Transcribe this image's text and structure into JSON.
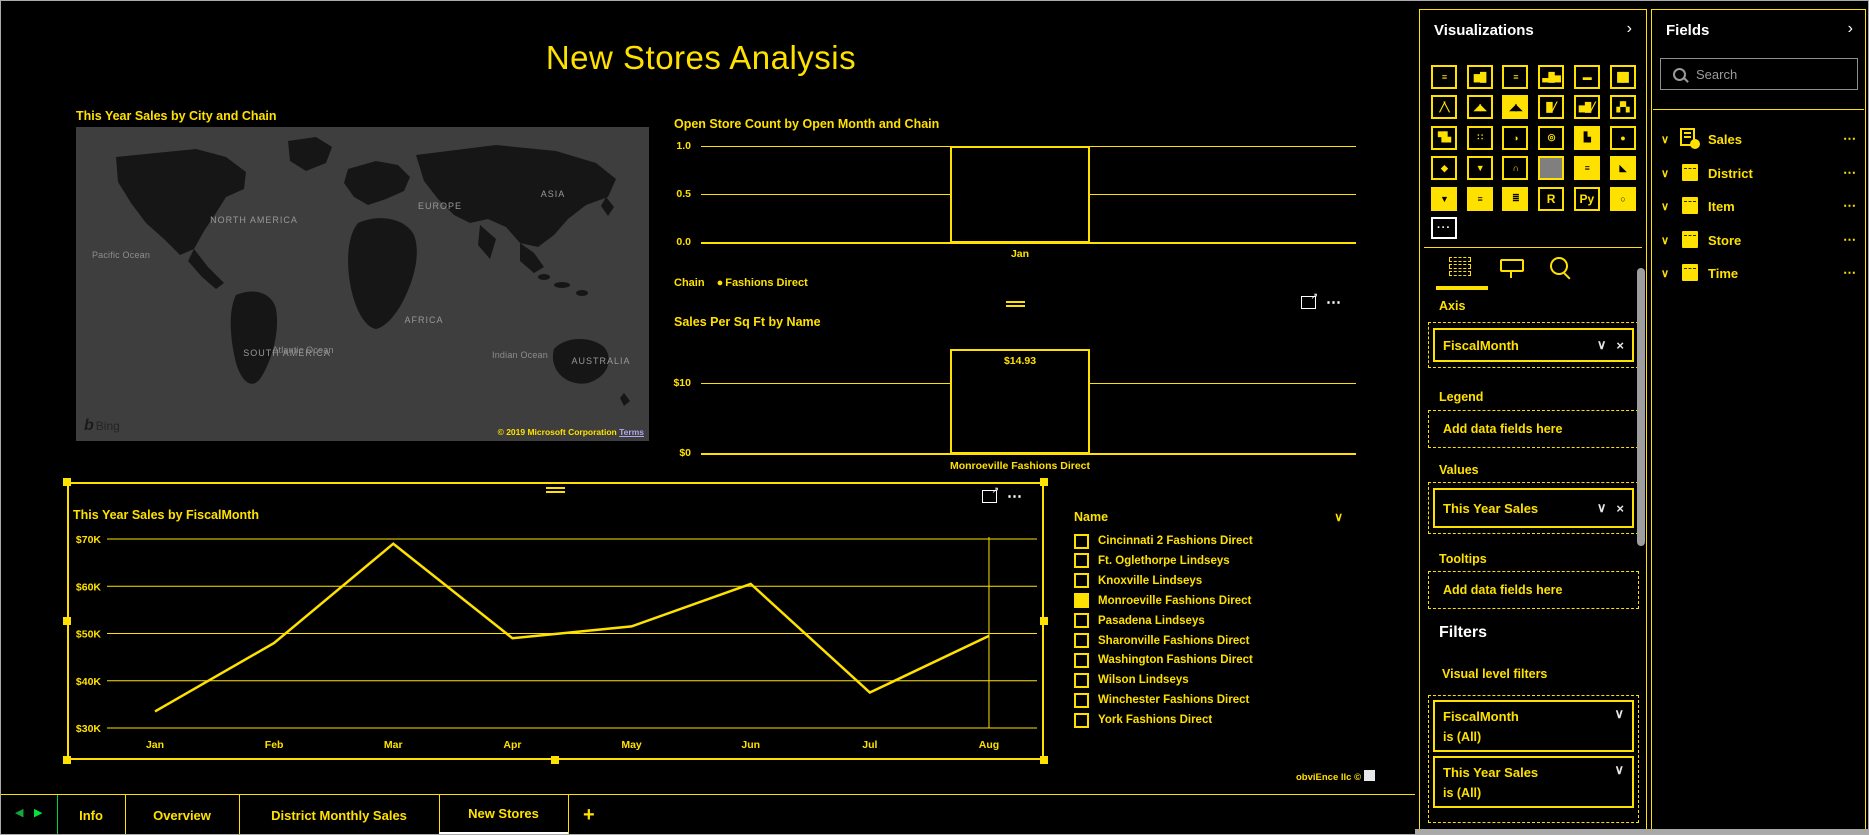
{
  "page_title": "New Stores Analysis",
  "glyphs": {
    "chevron_down": "∨",
    "chevron_right": "›",
    "close": "×",
    "ellipsis": "⋯",
    "dots": "···",
    "focus_arrow": "↗",
    "bullet": "●",
    "arrow_left": "◀",
    "arrow_right": "▶"
  },
  "map": {
    "title": "This Year Sales by City and Chain",
    "continents": [
      "NORTH AMERICA",
      "EUROPE",
      "ASIA",
      "AFRICA",
      "SOUTH AMERICA",
      "AUSTRALIA"
    ],
    "oceans": [
      "Pacific Ocean",
      "Atlantic Ocean",
      "Indian Ocean"
    ],
    "bing_label": "Bing",
    "attribution": "© 2019 Microsoft Corporation",
    "terms_label": "Terms"
  },
  "chain_legend": {
    "label": "Chain",
    "items": [
      "Fashions Direct"
    ]
  },
  "chart_data": [
    {
      "type": "bar",
      "title": "Open Store Count by Open Month and Chain",
      "categories": [
        "Jan"
      ],
      "values": [
        1
      ],
      "y_ticks": [
        "1.0",
        "0.5",
        "0.0"
      ],
      "ylim": [
        0,
        1
      ],
      "legend": {
        "title": "Chain",
        "items": [
          "Fashions Direct"
        ]
      }
    },
    {
      "type": "bar",
      "title": "Sales Per Sq Ft by Name",
      "categories": [
        "Monroeville Fashions Direct"
      ],
      "values": [
        14.93
      ],
      "data_labels": [
        "$14.93"
      ],
      "y_ticks": [
        "$10",
        "$0"
      ],
      "ylim": [
        0,
        15
      ]
    },
    {
      "type": "line",
      "title": "This Year Sales by FiscalMonth",
      "categories": [
        "Jan",
        "Feb",
        "Mar",
        "Apr",
        "May",
        "Jun",
        "Jul",
        "Aug"
      ],
      "values": [
        33500,
        48000,
        69000,
        49000,
        51500,
        60500,
        37500,
        49500
      ],
      "y_ticks": [
        "$70K",
        "$60K",
        "$50K",
        "$40K",
        "$30K"
      ],
      "ylim": [
        30000,
        70000
      ],
      "grid": true
    }
  ],
  "slicer": {
    "header": "Name",
    "items": [
      {
        "label": "Cincinnati 2 Fashions Direct",
        "checked": false
      },
      {
        "label": "Ft. Oglethorpe Lindseys",
        "checked": false
      },
      {
        "label": "Knoxville Lindseys",
        "checked": false
      },
      {
        "label": "Monroeville Fashions Direct",
        "checked": true
      },
      {
        "label": "Pasadena Lindseys",
        "checked": false
      },
      {
        "label": "Sharonville Fashions Direct",
        "checked": false
      },
      {
        "label": "Washington Fashions Direct",
        "checked": false
      },
      {
        "label": "Wilson Lindseys",
        "checked": false
      },
      {
        "label": "Winchester Fashions Direct",
        "checked": false
      },
      {
        "label": "York Fashions Direct",
        "checked": false
      }
    ]
  },
  "watermark": "obviEnce llc ©",
  "page_tabs": {
    "tabs": [
      "Info",
      "Overview",
      "District Monthly Sales",
      "New Stores"
    ],
    "active": "New Stores",
    "add_label": "+"
  },
  "viz_panel": {
    "header": "Visualizations",
    "icons": [
      {
        "name": "stacked-bar-chart",
        "glyph": "≡",
        "style": "outline"
      },
      {
        "name": "stacked-column-chart",
        "glyph": "▆█",
        "style": "outline"
      },
      {
        "name": "clustered-bar-chart",
        "glyph": "≡",
        "style": "outline"
      },
      {
        "name": "clustered-column-chart",
        "glyph": "▃█▅",
        "style": "outline"
      },
      {
        "name": "100-stacked-bar-chart",
        "glyph": "▬",
        "style": "outline"
      },
      {
        "name": "100-stacked-column-chart",
        "glyph": "██",
        "style": "outline"
      },
      {
        "name": "line-chart",
        "glyph": "╱╲",
        "style": "outline"
      },
      {
        "name": "area-chart",
        "glyph": "◢◣",
        "style": "outline"
      },
      {
        "name": "stacked-area-chart",
        "glyph": "◢◣",
        "style": "filled"
      },
      {
        "name": "line-and-stacked-column-chart",
        "glyph": "█╱",
        "style": "outline"
      },
      {
        "name": "line-and-clustered-column-chart",
        "glyph": "▅█╱",
        "style": "outline"
      },
      {
        "name": "ribbon-chart",
        "glyph": "▞▚",
        "style": "outline"
      },
      {
        "name": "waterfall-chart",
        "glyph": "▜▙",
        "style": "outline"
      },
      {
        "name": "scatter-chart",
        "glyph": "∷",
        "style": "outline"
      },
      {
        "name": "pie-chart",
        "glyph": "◑",
        "style": "outline"
      },
      {
        "name": "donut-chart",
        "glyph": "◎",
        "style": "outline"
      },
      {
        "name": "treemap",
        "glyph": "▙",
        "style": "filled"
      },
      {
        "name": "map",
        "glyph": "●",
        "style": "outline"
      },
      {
        "name": "filled-map",
        "glyph": "◆",
        "style": "outline"
      },
      {
        "name": "funnel-chart",
        "glyph": "▼",
        "style": "outline"
      },
      {
        "name": "gauge",
        "glyph": "∩",
        "style": "outline"
      },
      {
        "name": "card",
        "glyph": "",
        "style": "selected"
      },
      {
        "name": "multi-row-card",
        "glyph": "≡",
        "style": "filled"
      },
      {
        "name": "kpi",
        "glyph": "◣",
        "style": "filled"
      },
      {
        "name": "slicer",
        "glyph": "▼",
        "style": "filled"
      },
      {
        "name": "table",
        "glyph": "≡",
        "style": "filled"
      },
      {
        "name": "matrix",
        "glyph": "≣",
        "style": "filled"
      },
      {
        "name": "r-script-visual",
        "glyph": "R",
        "style": "text"
      },
      {
        "name": "python-visual",
        "glyph": "Py",
        "style": "text"
      },
      {
        "name": "arcgis-map",
        "glyph": "○",
        "style": "filled"
      }
    ],
    "wells": {
      "axis": {
        "label": "Axis",
        "field": "FiscalMonth"
      },
      "legend": {
        "label": "Legend",
        "placeholder": "Add data fields here"
      },
      "values": {
        "label": "Values",
        "field": "This Year Sales"
      },
      "tooltips": {
        "label": "Tooltips",
        "placeholder": "Add data fields here"
      }
    },
    "filters": {
      "header": "Filters",
      "subheader": "Visual level filters",
      "cards": [
        {
          "field": "FiscalMonth",
          "condition": "is (All)"
        },
        {
          "field": "This Year Sales",
          "condition": "is (All)"
        }
      ]
    }
  },
  "fields_panel": {
    "header": "Fields",
    "search_placeholder": "Search",
    "tables": [
      {
        "name": "Sales",
        "icon": "measures-table"
      },
      {
        "name": "District",
        "icon": "table"
      },
      {
        "name": "Item",
        "icon": "table"
      },
      {
        "name": "Store",
        "icon": "table"
      },
      {
        "name": "Time",
        "icon": "table"
      }
    ]
  }
}
